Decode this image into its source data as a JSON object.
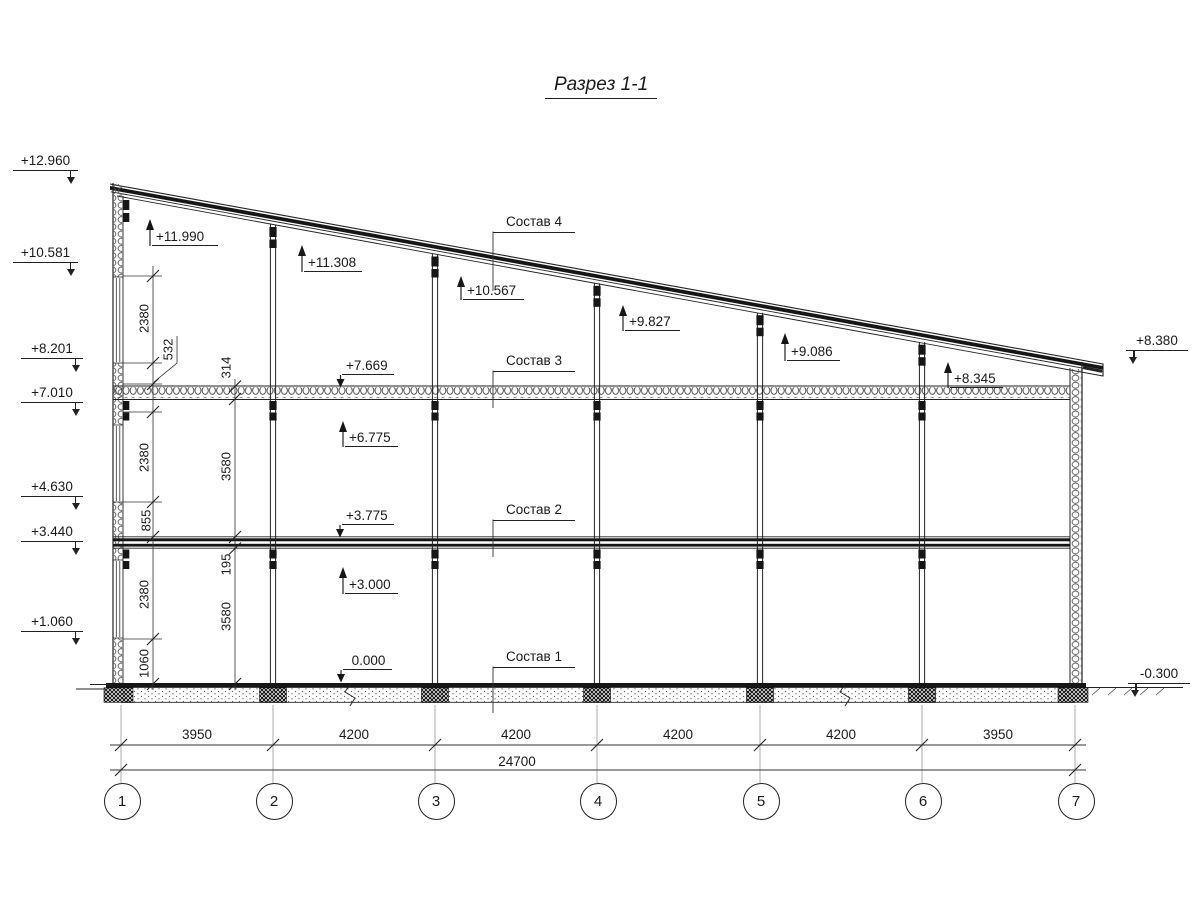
{
  "title": "Разрез 1-1",
  "elevations": {
    "left": [
      "+12.960",
      "+10.581",
      "+8.201",
      "+7.010",
      "+4.630",
      "+3.440",
      "+1.060"
    ],
    "right": [
      "+8.380",
      "-0.300"
    ],
    "interior_up": [
      "+11.990",
      "+11.308",
      "+10.567",
      "+9.827",
      "+9.086",
      "+8.345",
      "+6.775",
      "+3.000"
    ],
    "interior_down": [
      "+7.669",
      "+3.775",
      "0.000"
    ]
  },
  "layers": [
    "Состав 4",
    "Состав 3",
    "Состав 2",
    "Состав 1"
  ],
  "dims": {
    "vertical_inner": [
      "2380",
      "532",
      "2380",
      "855",
      "2380",
      "1060"
    ],
    "vertical_outer": [
      "314",
      "3580",
      "195",
      "3580"
    ],
    "bottom": [
      "3950",
      "4200",
      "4200",
      "4200",
      "4200",
      "3950"
    ],
    "total": "24700"
  },
  "axes": [
    "1",
    "2",
    "3",
    "4",
    "5",
    "6",
    "7"
  ]
}
